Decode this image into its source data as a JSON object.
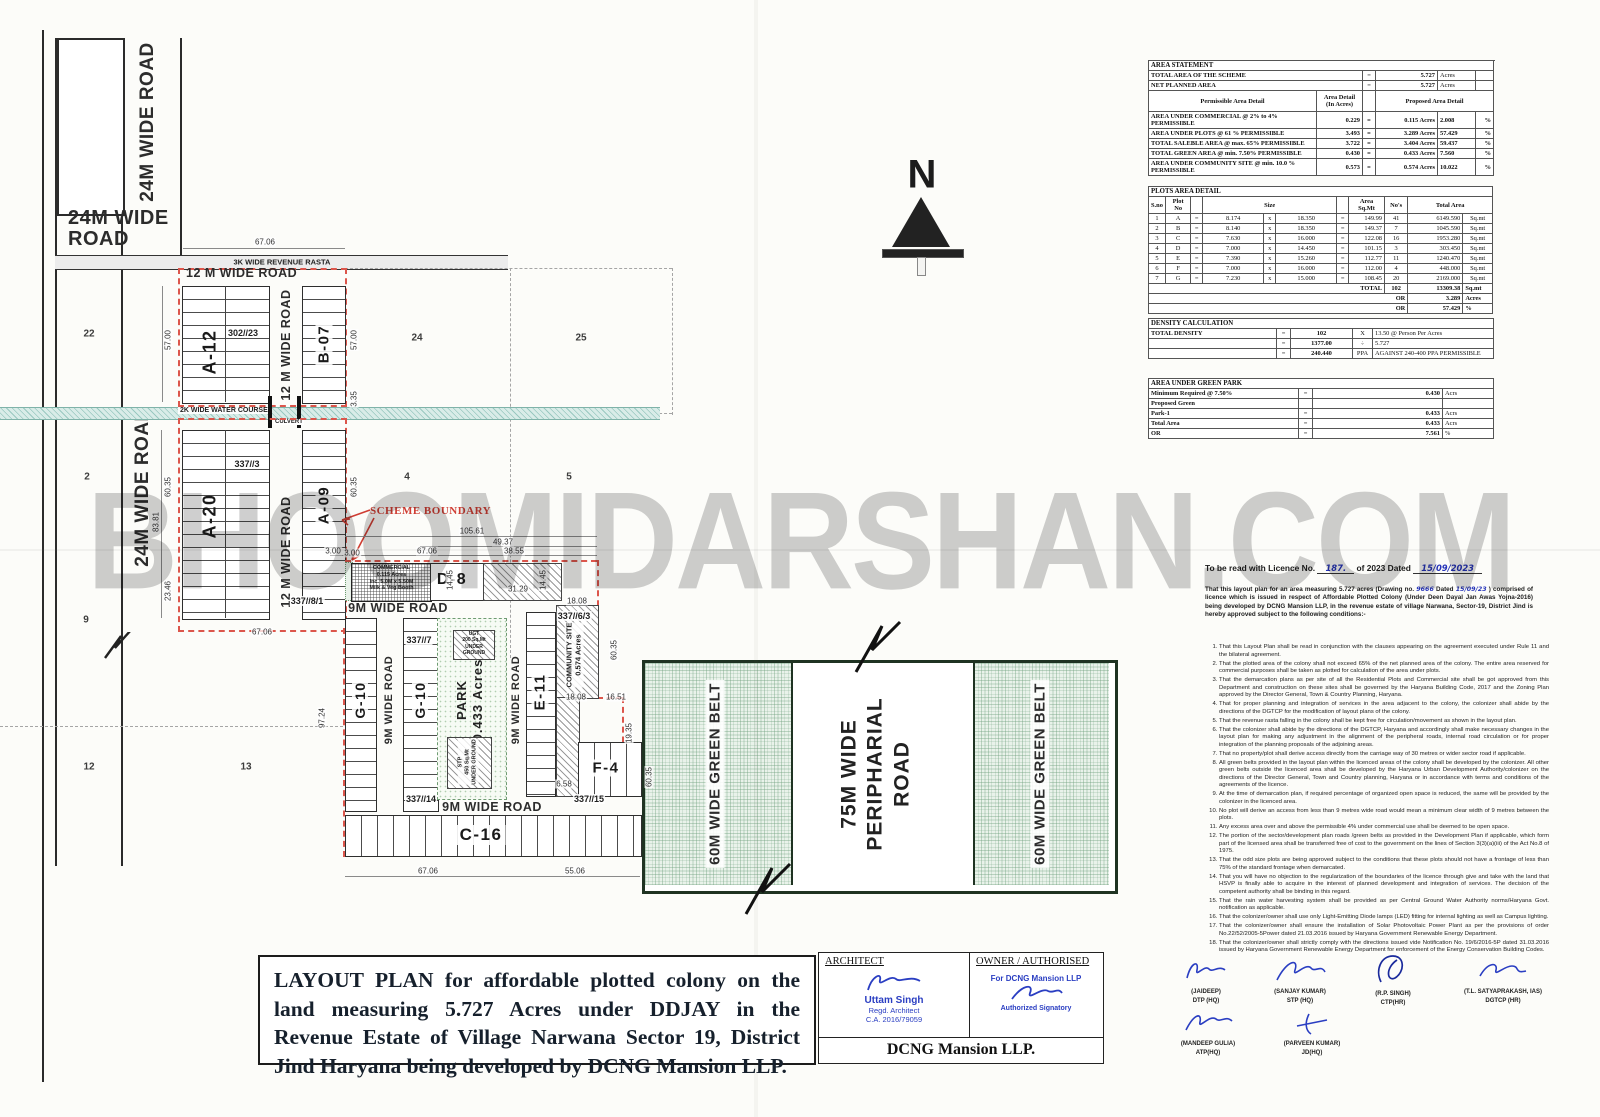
{
  "watermark": "BHOOMIDARSHAN.COM",
  "north": "N",
  "plan": {
    "labels": {
      "road24_top_v": "24M WIDE ROAD",
      "road24_left_v": "24M WIDE ROAD",
      "road24_h": "24M WIDE ROAD",
      "rasta": "3K WIDE REVENUE RASTA",
      "road12_top": "12 M WIDE ROAD",
      "road12_upper_v": "12 M WIDE ROAD",
      "road12_lower_v": "12 M WIDE ROAD",
      "water_course": "2K WIDE WATER COURSE",
      "culvert": "CULVERT",
      "scheme_boundary": "SCHEME BOUNDARY",
      "block_a12": "A-12",
      "block_b07": "B-07",
      "block_a20": "A-20",
      "block_a09": "A-09",
      "block_d8": "D-8",
      "block_g10a": "G-10",
      "block_g10b": "G-10",
      "block_e11": "E-11",
      "block_f4": "F-4",
      "block_c16": "C-16",
      "road9_top": "9M WIDE ROAD",
      "road9_v1": "9M WIDE ROAD",
      "road9_v2": "9M WIDE ROAD",
      "road9_bottom": "9M WIDE ROAD",
      "commercial": [
        "COMMERCIAL",
        "0.115 Acres",
        "Inc. 5.0M x 5.50M",
        "Milk & Veg Booth"
      ],
      "ugt": [
        "UGT",
        "200 Sq.Mt",
        "UNDER GROUND"
      ],
      "stp": [
        "STP",
        "450 Sq.Mt",
        "UNDER GROUND"
      ],
      "park": [
        "PARK",
        "0.433 Acres"
      ],
      "community": [
        "COMMUNITY SITE",
        "0.574 Acres"
      ],
      "green_belt_left": "60M WIDE GREEN BELT",
      "green_belt_right": "60M WIDE GREEN BELT",
      "peripheral_road": [
        "75M WIDE",
        "PERIPHARIAL",
        "ROAD"
      ]
    },
    "annotations": [
      {
        "t": "67.06",
        "x": 265,
        "y": 242,
        "r": 0,
        "c": "dim"
      },
      {
        "t": "57.00",
        "x": 168,
        "y": 340,
        "r": -90,
        "c": "dim"
      },
      {
        "t": "57.00",
        "x": 354,
        "y": 340,
        "r": -90,
        "c": "dim"
      },
      {
        "t": "3.35",
        "x": 354,
        "y": 399,
        "r": -90,
        "c": "dim"
      },
      {
        "t": "60.35",
        "x": 168,
        "y": 487,
        "r": -90,
        "c": "dim"
      },
      {
        "t": "83.81",
        "x": 156,
        "y": 522,
        "r": -90,
        "c": "dim"
      },
      {
        "t": "23.46",
        "x": 168,
        "y": 591,
        "r": -90,
        "c": "dim"
      },
      {
        "t": "60.35",
        "x": 354,
        "y": 487,
        "r": -90,
        "c": "dim"
      },
      {
        "t": "3.00",
        "x": 352,
        "y": 553,
        "r": 0,
        "c": "dim"
      },
      {
        "t": "67.06",
        "x": 262,
        "y": 632,
        "r": 0,
        "c": "dim"
      },
      {
        "t": "105.61",
        "x": 472,
        "y": 531,
        "r": 0,
        "c": "dim"
      },
      {
        "t": "49.37",
        "x": 503,
        "y": 542,
        "r": 0,
        "c": "dim"
      },
      {
        "t": "38.55",
        "x": 514,
        "y": 551,
        "r": 0,
        "c": "dim"
      },
      {
        "t": "3.00",
        "x": 333,
        "y": 551,
        "r": 0,
        "c": "dim"
      },
      {
        "t": "67.06",
        "x": 427,
        "y": 551,
        "r": 0,
        "c": "dim"
      },
      {
        "t": "14.45",
        "x": 450,
        "y": 580,
        "r": -90,
        "c": "dim"
      },
      {
        "t": "14.45",
        "x": 543,
        "y": 580,
        "r": -90,
        "c": "dim"
      },
      {
        "t": "31.29",
        "x": 518,
        "y": 589,
        "r": 0,
        "c": "dim"
      },
      {
        "t": "18.08",
        "x": 577,
        "y": 601,
        "r": 0,
        "c": "dim"
      },
      {
        "t": "60.35",
        "x": 614,
        "y": 650,
        "r": -90,
        "c": "dim"
      },
      {
        "t": "18.08",
        "x": 576,
        "y": 697,
        "r": 0,
        "c": "dim"
      },
      {
        "t": "16.51",
        "x": 616,
        "y": 697,
        "r": 0,
        "c": "dim"
      },
      {
        "t": "19.35",
        "x": 629,
        "y": 733,
        "r": -90,
        "c": "dim"
      },
      {
        "t": "6.58",
        "x": 564,
        "y": 784,
        "r": 0,
        "c": "dim"
      },
      {
        "t": "60.35",
        "x": 649,
        "y": 777,
        "r": -90,
        "c": "dim"
      },
      {
        "t": "97.24",
        "x": 322,
        "y": 718,
        "r": -90,
        "c": "dim"
      },
      {
        "t": "67.06",
        "x": 428,
        "y": 871,
        "r": 0,
        "c": "dim"
      },
      {
        "t": "55.06",
        "x": 575,
        "y": 871,
        "r": 0,
        "c": "dim"
      },
      {
        "t": "22",
        "x": 89,
        "y": 334,
        "r": 0,
        "c": "fieldno"
      },
      {
        "t": "24",
        "x": 417,
        "y": 338,
        "r": 0,
        "c": "fieldno"
      },
      {
        "t": "25",
        "x": 581,
        "y": 338,
        "r": 0,
        "c": "fieldno"
      },
      {
        "t": "2",
        "x": 87,
        "y": 477,
        "r": 0,
        "c": "fieldno"
      },
      {
        "t": "4",
        "x": 407,
        "y": 477,
        "r": 0,
        "c": "fieldno"
      },
      {
        "t": "5",
        "x": 569,
        "y": 477,
        "r": 0,
        "c": "fieldno"
      },
      {
        "t": "9",
        "x": 86,
        "y": 620,
        "r": 0,
        "c": "fieldno"
      },
      {
        "t": "12",
        "x": 89,
        "y": 767,
        "r": 0,
        "c": "fieldno"
      },
      {
        "t": "13",
        "x": 246,
        "y": 767,
        "r": 0,
        "c": "fieldno"
      },
      {
        "t": "302//23",
        "x": 243,
        "y": 333,
        "r": 0,
        "c": "khasra"
      },
      {
        "t": "337//3",
        "x": 247,
        "y": 464,
        "r": 0,
        "c": "khasra"
      },
      {
        "t": "337//8/1",
        "x": 307,
        "y": 601,
        "r": 0,
        "c": "khasra"
      },
      {
        "t": "337//7",
        "x": 419,
        "y": 640,
        "r": 0,
        "c": "khasra"
      },
      {
        "t": "337//14",
        "x": 421,
        "y": 799,
        "r": 0,
        "c": "khasra"
      },
      {
        "t": "337//15",
        "x": 589,
        "y": 799,
        "r": 0,
        "c": "khasra"
      },
      {
        "t": "337//6/3",
        "x": 574,
        "y": 616,
        "r": 0,
        "c": "khasra"
      }
    ]
  },
  "tables": {
    "eq": "=",
    "area_statement": {
      "title": "AREA STATEMENT",
      "r1": [
        "TOTAL AREA OF THE SCHEME",
        "5.727",
        "Acres"
      ],
      "r2": [
        "NET PLANNED AREA",
        "5.727",
        "Acres"
      ],
      "header": {
        "c1": "Permissible Area Detail",
        "c2": "Area Detail (In Acres)",
        "c3": "Proposed Area Detail"
      },
      "rows": [
        [
          "AREA UNDER COMMERCIAL @ 2% to 4%  PERMISSIBLE",
          "0.229",
          "=",
          "0.115  Acres",
          "2.008",
          "%",
          ""
        ],
        [
          "AREA UNDER PLOTS @ 61 % PERMISSIBLE",
          "3.493",
          "=",
          "3.289  Acres",
          "57.429",
          "%",
          ""
        ],
        [
          "TOTAL SALEBLE AREA @ max. 65% PERMISSIBLE",
          "3.722",
          "=",
          "3.404  Acres",
          "59.437",
          "%",
          ""
        ],
        [
          "TOTAL GREEN AREA @ min. 7.50% PERMISSIBLE",
          "0.430",
          "=",
          "0.433  Acres",
          "7.560",
          "%",
          ""
        ],
        [
          "AREA UNDER COMMUNITY SITE @ min. 10.0 % PERMISSIBLE",
          "0.573",
          "=",
          "0.574  Acres",
          "10.022",
          "%",
          ""
        ]
      ]
    },
    "plots": {
      "title": "PLOTS AREA DETAIL",
      "h": {
        "sno": "S.no",
        "plot": "Plot No",
        "size": "Size",
        "area": "Area Sq.Mt",
        "nos": "No's",
        "total": "Total Area"
      },
      "rows": [
        [
          "1",
          "A",
          "=",
          "8.174",
          "x",
          "18.350",
          "=",
          "149.99",
          "41",
          "6149.590",
          "Sq.mt"
        ],
        [
          "2",
          "B",
          "=",
          "8.140",
          "x",
          "18.350",
          "=",
          "149.37",
          "7",
          "1045.590",
          "Sq.mt"
        ],
        [
          "3",
          "C",
          "=",
          "7.630",
          "x",
          "16.000",
          "=",
          "122.08",
          "16",
          "1953.280",
          "Sq.mt"
        ],
        [
          "4",
          "D",
          "=",
          "7.000",
          "x",
          "14.450",
          "=",
          "101.15",
          "3",
          "303.450",
          "Sq.mt"
        ],
        [
          "5",
          "E",
          "=",
          "7.390",
          "x",
          "15.260",
          "=",
          "112.77",
          "11",
          "1240.470",
          "Sq.mt"
        ],
        [
          "6",
          "F",
          "=",
          "7.000",
          "x",
          "16.000",
          "=",
          "112.00",
          "4",
          "448.000",
          "Sq.mt"
        ],
        [
          "7",
          "G",
          "=",
          "7.230",
          "x",
          "15.000",
          "=",
          "108.45",
          "20",
          "2169.000",
          "Sq.mt"
        ]
      ],
      "total_label": "TOTAL",
      "total_nos": "102",
      "total_value": "13309.38",
      "total_unit": "Sq.mt",
      "or_label": "OR",
      "or1_value": "3.289",
      "or1_unit": "Acres",
      "or2_value": "57.429",
      "or2_unit": "%"
    },
    "density": {
      "title": "DENSITY CALCULATION",
      "rows": [
        [
          "TOTAL DENSITY",
          "=",
          "102",
          "X",
          "13.50  @ Person Per Acres"
        ],
        [
          "",
          "=",
          "1377.00",
          "÷",
          "5.727"
        ],
        [
          "",
          "=",
          "240.440",
          "PPA",
          "AGAINST 240-400 PPA PERMISSIBLE"
        ]
      ]
    },
    "green_park": {
      "title": "AREA UNDER GREEN PARK",
      "rows": [
        [
          "Minimum Required @ 7.50%",
          "=",
          "0.430",
          "Acrs"
        ],
        [
          "Proposed Green",
          "",
          "",
          ""
        ],
        [
          "Park-1",
          "=",
          "0.433",
          "Acrs"
        ],
        [
          "Total Area",
          "=",
          "0.433",
          "Acrs"
        ],
        [
          "OR",
          "=",
          "7.561",
          "%"
        ]
      ]
    }
  },
  "licence": {
    "prefix": "To be read with Licence No.",
    "no": "187.",
    "mid": "of 2023   Dated",
    "date": "15/09/2023",
    "p1": "That this layout plan for an area measuring 5.727 acres (Drawing no.",
    "drawing_no": "9666",
    "p2": "Dated",
    "drawing_date": "15/09/23",
    "p3": ") comprised of licence which is issued in respect of Affordable Plotted Colony (Under Deen Dayal Jan Awas Yojna-2016) being developed by DCNG Mansion LLP, in the revenue estate of village Narwana, Sector-19, District Jind is hereby approved subject to the following conditions:-",
    "conditions": [
      "That this Layout Plan shall be read in conjunction with the clauses appearing on the agreement executed under Rule 11 and the bilateral agreement.",
      "That the plotted area of the colony shall not exceed 65% of the net planned area of the colony. The entire area reserved for commercial purposes shall be taken as plotted for calculation of the area under plots.",
      "That the demarcation plans as per site of all the Residential Plots and Commercial site shall be got approved from this Department and construction on these sites shall be governed by the Haryana Building Code, 2017 and the Zoning Plan approved by the Director General, Town & Country Planning, Haryana.",
      "That for proper planning and integration of services in the area adjacent to the colony, the colonizer shall abide by the directions of the DGTCP for the modification of layout plans of the colony.",
      "That the revenue rasta falling in the colony shall be kept free for circulation/movement as shown in the layout plan.",
      "That the colonizer shall abide by the directions of the DGTCP, Haryana and accordingly shall make necessary changes in the layout plan for making any adjustment in the alignment of the peripheral roads, internal road circulation or for proper integration of the planning proposals of the adjoining areas.",
      "That no property/plot shall derive access directly from the carriage way of 30 metres or wider sector road if applicable.",
      "All green belts provided in the layout plan within the licenced areas of the colony shall be developed by the colonizer. All other green belts outside the licenced area shall be developed by the Haryana Urban Development Authority/colonizer on the directions of the Director General, Town and Country planning, Haryana or in accordance with terms and conditions of the agreements of the licence.",
      "At the time of demarcation plan, if required percentage of organized open space is reduced, the same will be provided by the colonizer in the licenced area.",
      "No plot will derive an access from less than 9 metres wide road would mean a minimum clear width of 9 metres between the plots.",
      "Any excess area over and above the permissible 4% under commercial use shall be deemed to be open space.",
      "The portion of the sector/development plan roads /green belts as provided in the Development Plan if applicable, which form part of the licensed area shall be transferred free of cost to the government on the lines of Section 3(3)(a)(iii) of the Act No.8 of 1975.",
      "That the odd size plots are being approved subject to the conditions that these plots should not have a frontage of less than 75% of the standard frontage when demarcated.",
      "That you will have no objection to the regularization of the boundaries of the licence through give and take with the land that HSVP is finally able to acquire in the interest of planned development and integration of services. The decision of the competent authority shall be binding in this regard.",
      "That the rain water harvesting system shall be provided as per Central Ground Water Authority norms/Haryana Govt. notification as applicable.",
      "That the colonizer/owner shall use only Light-Emitting Diode lamps (LED) fitting for internal lighting as well as Campus lighting.",
      "That the colonizer/owner shall ensure the installation of Solar Photovoltaic Power Plant as per the provisions of order No.22/52/2005-5Power dated 21.03.2016 issued by Haryana Government Renewable Energy Department.",
      "That the colonizer/owner shall strictly comply with the directions issued vide Notification No. 19/6/2016-5P dated 31.03.2016 issued by Haryana Government Renewable Energy Department for enforcement of the Energy Conservation Building Codes."
    ]
  },
  "signatures": [
    {
      "name": "(JAIDEEP)",
      "title": "DTP (HQ)"
    },
    {
      "name": "(SANJAY KUMAR)",
      "title": "STP (HQ)"
    },
    {
      "name": "(R.P. SINGH)",
      "title": "CTP(HR)"
    },
    {
      "name": "(T.L. SATYAPRAKASH, IAS)",
      "title": "DGTCP (HR)"
    },
    {
      "name": "(MANDEEP GULIA)",
      "title": "ATP(HQ)"
    },
    {
      "name": "(PARVEEN KUMAR)",
      "title": "JD(HQ)"
    }
  ],
  "title_block": {
    "text": "LAYOUT PLAN for affordable plotted colony on the land measuring 5.727 Acres under DDJAY in the Revenue Estate of Village Narwana Sector 19, District Jind Haryana being developed by DCNG Mansion LLP."
  },
  "architect_block": {
    "header": "ARCHITECT",
    "name": "Uttam Singh",
    "line2": "Regd. Architect",
    "line3": "C.A. 2016/79059"
  },
  "owner_block": {
    "header": "OWNER / AUTHORISED",
    "stamp1": "For DCNG Mansion LLP",
    "stamp2": "Authorized Signatory"
  },
  "company": "DCNG Mansion LLP."
}
